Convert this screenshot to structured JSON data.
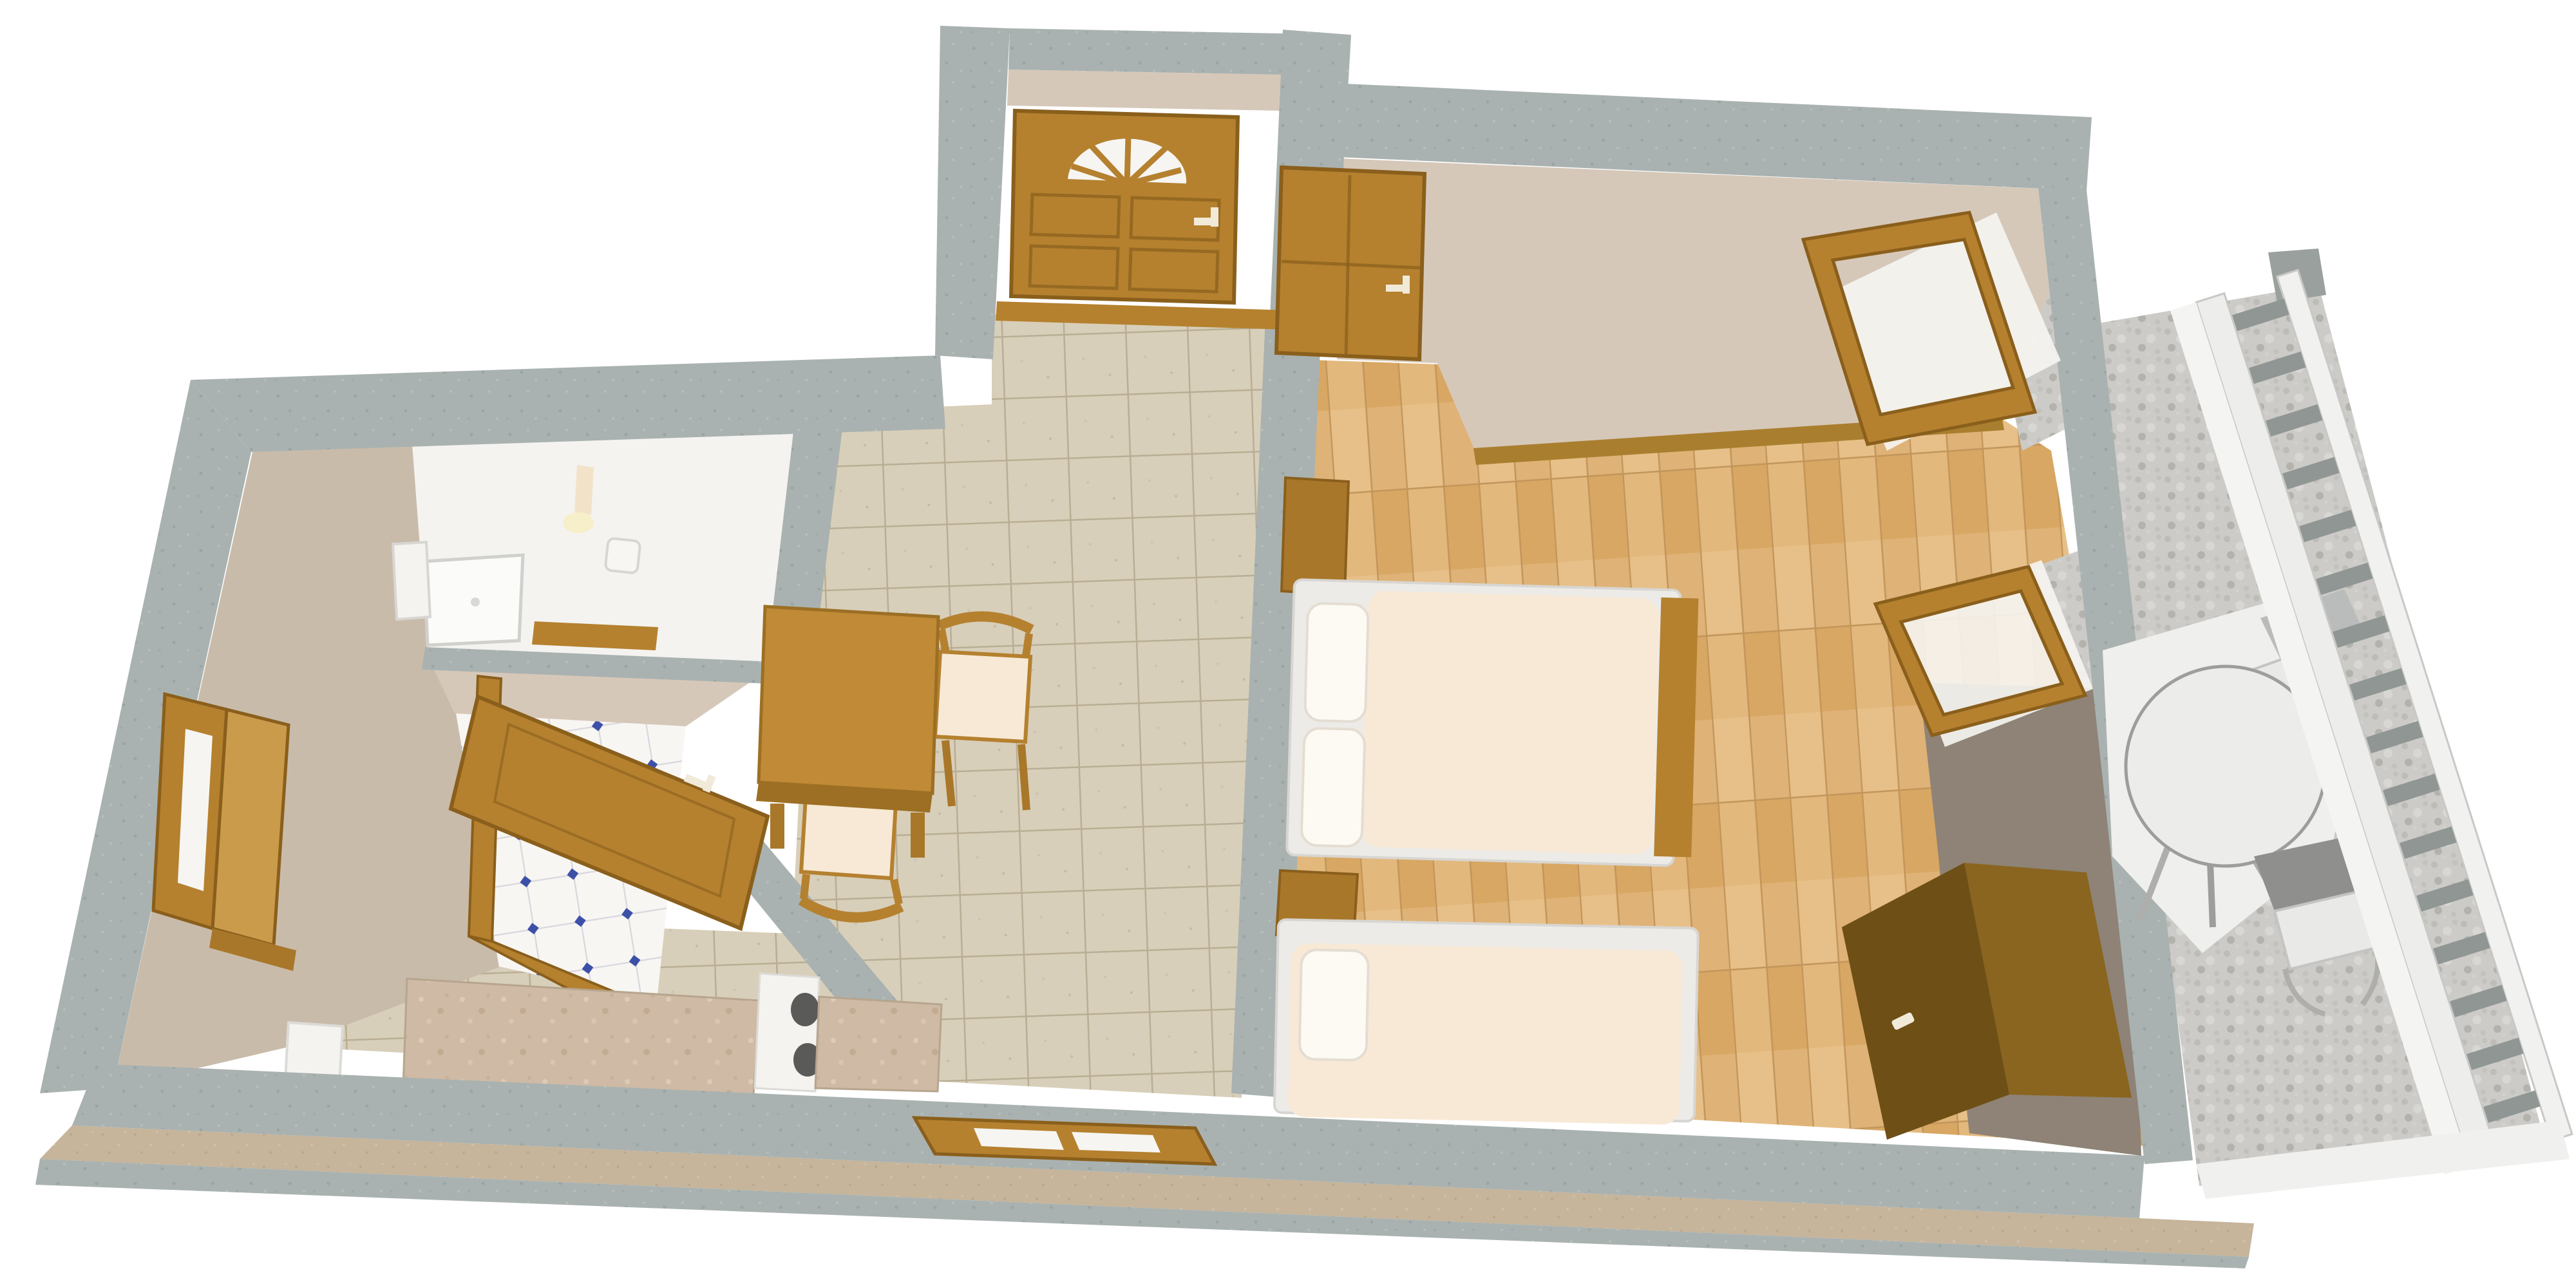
{
  "scene": {
    "title": "Apartment 3D floor plan",
    "type": "isometric-3d-floor-plan",
    "background": "#ffffff",
    "description": "Top-down 3D rendering of a one-bedroom apartment with entry hall, bathroom, WC nook, kitchenette, dining corner, bedroom with two beds, and a gravel balcony with outdoor furniture"
  },
  "colors": {
    "wall_concrete": "#a9b2b0",
    "wall_face_beige": "#c9bbaa",
    "wall_face_light": "#d6c8b9",
    "wall_face_taupe": "#8e8376",
    "hall_tile": "#d8cfba",
    "hall_tile_grout": "#b9ae94",
    "parquet": "#dfb277",
    "parquet_line": "#c2955a",
    "bath_floor": "#f4f3f0",
    "kitchen_tile": "#f7f6f3",
    "kitchen_tile_accent": "#3c50a8",
    "wood": "#b5812f",
    "wood_dark": "#8a5f1c",
    "wood_light": "#c99b4b",
    "wardrobe_front": "#6e4f16",
    "wardrobe_top": "#8a6520",
    "mattress": "#f8e9d6",
    "bed_frame": "#edebe7",
    "pillow": "#fdfaf4",
    "marble_counter": "#cfbaa5",
    "appliance_white": "#f5f3f0",
    "burner_dark": "#5a5a58",
    "gravel": "#cccbc7",
    "railing_white": "#f1f1ef",
    "railing_slat": "#8f9694",
    "patio_white": "#efefed",
    "plinth": "#c6b49b",
    "glass_white": "#f6f5f2",
    "handle_white": "#f2ead9"
  },
  "rooms": [
    {
      "id": "bathroom",
      "name": "Bathroom",
      "floor": "white ceramic",
      "items": [
        "shower tray",
        "washbasin",
        "toilet",
        "wall lamp",
        "wooden shelf"
      ]
    },
    {
      "id": "wc",
      "name": "WC / storage nook",
      "floor": "white tiles with blue diamond accents",
      "items": [
        "open wooden door"
      ]
    },
    {
      "id": "hall",
      "name": "Hallway / dining area",
      "floor": "beige ceramic tiles",
      "items": [
        "dining table",
        "2 chairs"
      ]
    },
    {
      "id": "kitchen",
      "name": "Kitchenette",
      "floor": "beige ceramic tiles",
      "items": [
        "marble counter left",
        "stove",
        "marble counter right",
        "refrigerator"
      ]
    },
    {
      "id": "bedroom",
      "name": "Bedroom",
      "floor": "light oak parquet",
      "items": [
        "double bed",
        "single bed",
        "2 nightstands",
        "wardrobe"
      ]
    },
    {
      "id": "balcony",
      "name": "Balcony terrace",
      "floor": "grey gravel with white paving",
      "items": [
        "round table",
        "2 chairs",
        "white railing"
      ]
    }
  ],
  "openings": {
    "entry_door": {
      "name": "Entry door",
      "style": "panel door with arched fanlight",
      "panels": 4,
      "state": "closed",
      "handle": "white"
    },
    "bedroom_door": {
      "name": "Bedroom door",
      "state": "open",
      "handle": "white"
    },
    "wc_door": {
      "name": "WC door",
      "state": "open",
      "handle": "white"
    },
    "left_window": {
      "name": "West wall window",
      "state": "open shutter"
    },
    "bottom_window": {
      "name": "South wall window",
      "state": "open",
      "panes": 2
    },
    "balcony_door": {
      "name": "Balcony door",
      "state": "open"
    },
    "balcony_window": {
      "name": "Balcony window",
      "state": "open"
    }
  },
  "furniture": {
    "double_bed": {
      "name": "Double bed",
      "pillows": 2
    },
    "single_bed": {
      "name": "Single bed",
      "pillows": 1
    },
    "wardrobe": {
      "name": "Wardrobe",
      "handle": "white"
    },
    "dining_table": {
      "name": "Dining table",
      "seats": 2
    },
    "balcony_table": {
      "name": "Round balcony table",
      "seats": 2
    },
    "stove": {
      "name": "Stove",
      "burners": 2
    },
    "fridge": {
      "name": "Refrigerator"
    }
  },
  "balcony": {
    "railing_slats": 16
  }
}
